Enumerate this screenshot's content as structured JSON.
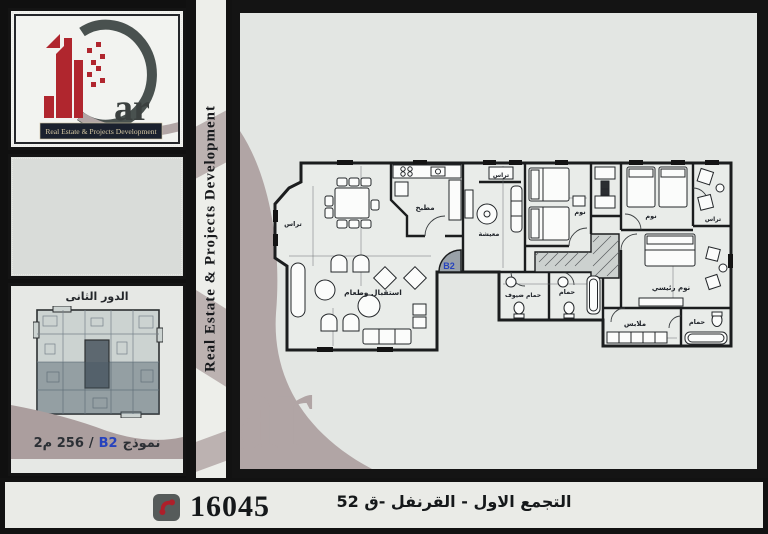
{
  "brand": {
    "logo_suffix": "ar",
    "tagline": "Real Estate & Projects Development",
    "side_text": "Real Estate & Projects Development",
    "watermark": "ar",
    "colors": {
      "logo_red": "#b0262e",
      "logo_dark": "#49514f",
      "mauve": "#b1a5a5",
      "unit_blue": "#2743bd"
    }
  },
  "left_panel": {
    "floor_title": "الدور الثانى",
    "caption": {
      "model_label": "نموذج",
      "model_code": "B2",
      "separator": "/",
      "area": "256 م2"
    }
  },
  "plan": {
    "unit_label": "B2",
    "labels": {
      "terrace_left": "تراس",
      "kitchen": "مطبخ",
      "terrace_top": "تراس",
      "living": "معيشة",
      "bedroom_1": "نوم",
      "bedroom_2": "نوم",
      "terrace_right": "تراس",
      "master_bedroom": "نوم رئيسي",
      "master_bath": "حمام",
      "dressing": "ملابس",
      "bath": "حمام",
      "guest_bath": "حمام ضيوف",
      "reception": "استقبال وطعام"
    }
  },
  "footer": {
    "phone": "16045",
    "location": "التجمع الاول - القرنفل -ق 52"
  }
}
